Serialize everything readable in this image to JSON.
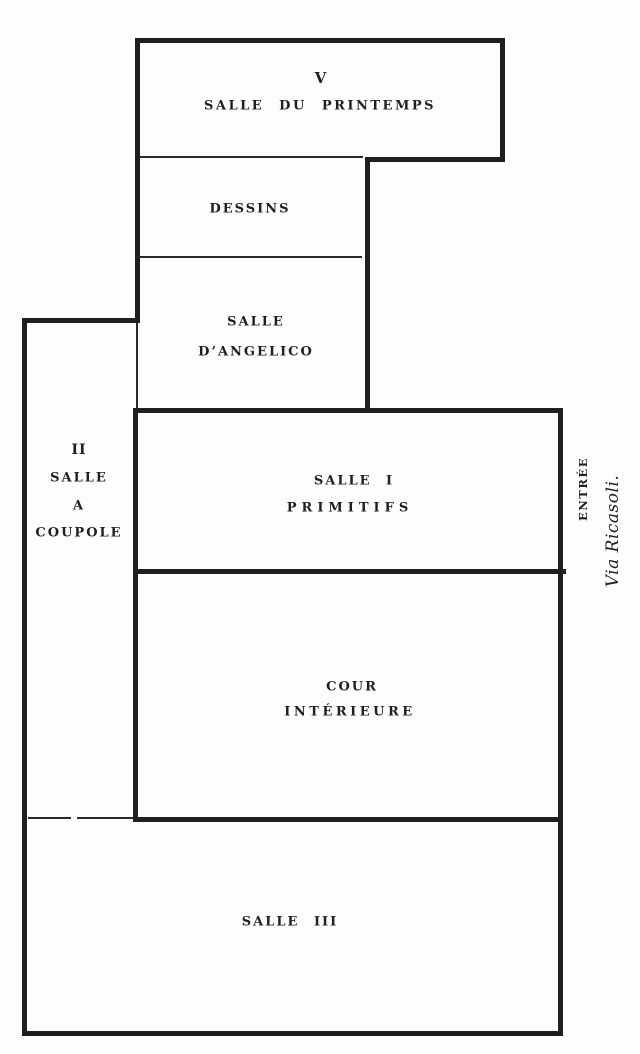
{
  "colors": {
    "ink": "#1f1f1f",
    "paper": "#fdfdfb"
  },
  "rooms": {
    "salle_du_printemps": {
      "number": "V",
      "name": "SALLE DU PRINTEMPS"
    },
    "dessins": {
      "name": "DESSINS"
    },
    "salle_angelico": {
      "name_line1": "SALLE",
      "name_line2": "D’ANGELICO"
    },
    "salle_a_coupole": {
      "number": "II",
      "name_line1": "SALLE",
      "name_line2": "A",
      "name_line3": "COUPOLE"
    },
    "salle_1": {
      "name_line1": "SALLE I",
      "name_line2": "PRIMITIFS"
    },
    "cour_interieure": {
      "name_line1": "COUR",
      "name_line2": "INTÉRIEURE"
    },
    "salle_3": {
      "name": "SALLE III"
    }
  },
  "annotations": {
    "entrance_label": "ENTRÉE",
    "street_label": "Via Ricasoli."
  }
}
